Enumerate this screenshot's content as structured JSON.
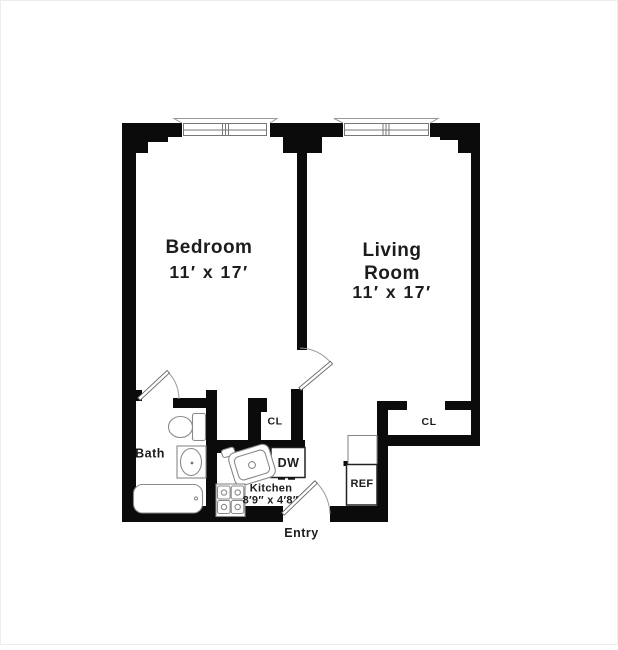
{
  "plan": {
    "bedroom": {
      "name": "Bedroom",
      "dim": "11′ x 17′"
    },
    "living": {
      "name1": "Living",
      "name2": "Room",
      "dim": "11′ x 17′"
    },
    "bath": {
      "name": "Bath"
    },
    "kitchen": {
      "name": "Kitchen",
      "dim": "8′9″ x 4′8″"
    },
    "entry": {
      "name": "Entry"
    },
    "closets": {
      "left": "CL",
      "right": "CL"
    },
    "appliances": {
      "dw": "DW",
      "ref": "REF"
    },
    "colors": {
      "wall": "#0b0b0b",
      "fixture_stroke": "#8a8a8a",
      "text": "#1c1c1c",
      "background": "#ffffff"
    }
  }
}
